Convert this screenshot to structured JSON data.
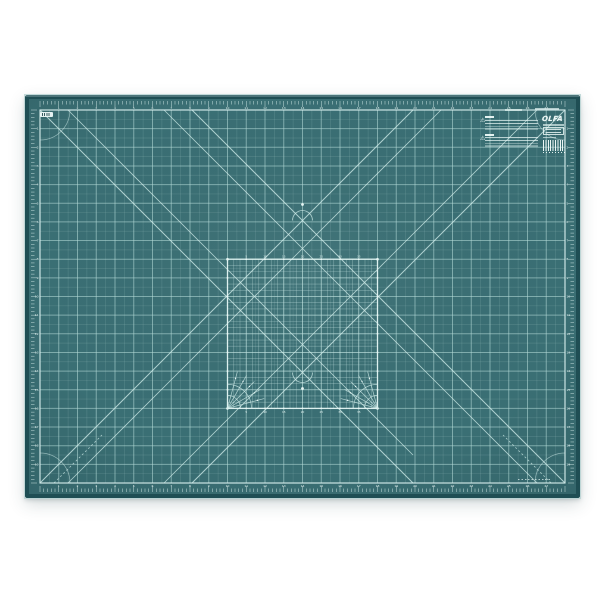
{
  "scene": {
    "background": "#ffffff"
  },
  "labels": {
    "logo": "OLFA"
  },
  "icons": {
    "warning_triangle": "⚠"
  },
  "mat": {
    "colors": {
      "body": "#3a6f74",
      "edge": "#1f4e54",
      "grid_major": "rgba(184,222,219,0.55)",
      "grid_half": "rgba(168,206,203,0.20)",
      "frame": "rgba(219,240,238,0.85)",
      "tick": "rgba(224,244,242,0.85)",
      "number": "rgba(238,251,249,0.92)",
      "diagonal": "rgba(209,237,234,0.78)",
      "square_fine": "rgba(199,231,228,0.45)",
      "square_outline": "rgba(224,243,241,0.95)",
      "dot": "#e8f7f5"
    },
    "geometry": {
      "width": 555,
      "height": 403,
      "edge_band": 4,
      "frame": {
        "x": 15,
        "y": 15,
        "w": 525,
        "h": 373
      },
      "cols": 28,
      "rows": 20,
      "minors_per_cell": 5,
      "square": {
        "c0": 10,
        "c1": 18,
        "r0": 8,
        "r1": 16,
        "subdiv": 3
      },
      "diagonals": [
        [
          15,
          15,
          388,
          388
        ],
        [
          43,
          15,
          388,
          360
        ],
        [
          540,
          15,
          167,
          388
        ],
        [
          512,
          15,
          139,
          388
        ],
        [
          15,
          388,
          388,
          15
        ],
        [
          43,
          388,
          416,
          15
        ],
        [
          167,
          15,
          540,
          388
        ],
        [
          139,
          15,
          512,
          388
        ]
      ],
      "dashed_segments": [
        [
          29,
          388,
          77,
          340
        ],
        [
          526,
          388,
          478,
          340
        ]
      ],
      "corner_arc_radius": 30,
      "fan_angles": [
        15,
        30,
        45,
        60,
        75
      ],
      "cross_marks": [
        {
          "x": 277.5,
          "y": 125.5,
          "open": "up"
        },
        {
          "x": 277.5,
          "y": 277.5,
          "open": "down"
        }
      ]
    },
    "ruler_numbers": {
      "horizontal": [
        1,
        2,
        3,
        4,
        5,
        6,
        7,
        8,
        9,
        10,
        11,
        12,
        13,
        14,
        15,
        16,
        17,
        18,
        19,
        20,
        21,
        22,
        23,
        24,
        25,
        26,
        27
      ],
      "vertical": [
        1,
        2,
        3,
        4,
        5,
        6,
        7,
        8,
        9,
        10,
        11,
        12,
        13,
        14,
        15,
        16,
        17,
        18,
        19
      ],
      "square_scale": [
        5,
        10,
        15,
        20,
        25,
        30,
        35
      ]
    }
  }
}
